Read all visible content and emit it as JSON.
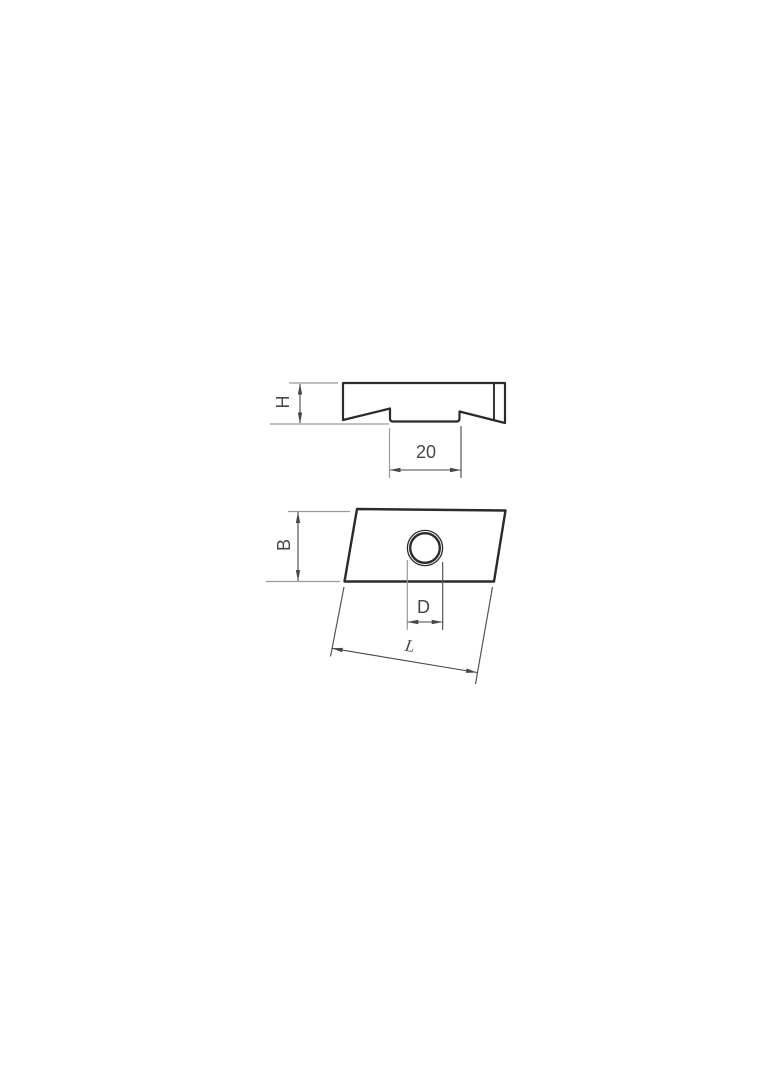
{
  "labels": {
    "height": "H",
    "slot_width": "20",
    "width": "B",
    "diameter": "D",
    "length": "L"
  },
  "colors": {
    "background": "#ffffff",
    "outline": "#2b2b2b",
    "dimension": "#474747",
    "extension_light": "#9a9a9a",
    "extension_dark": "#555555",
    "text": "#474747"
  }
}
